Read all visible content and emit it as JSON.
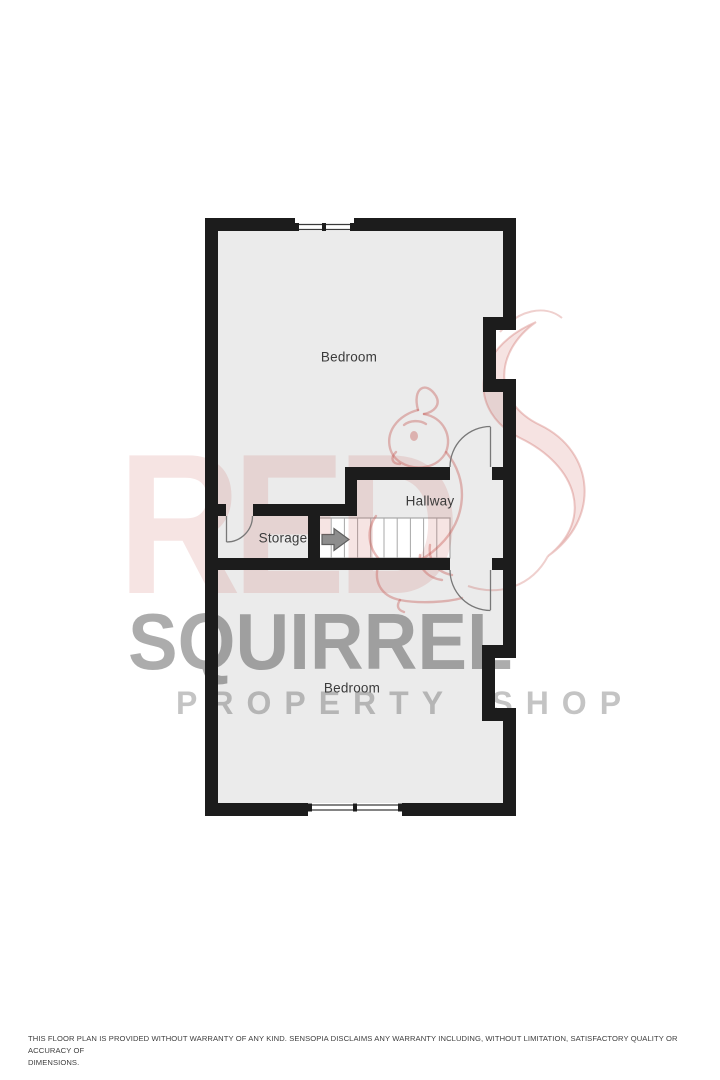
{
  "floorplan": {
    "rooms": [
      {
        "id": "bedroom-top",
        "label": "Bedroom"
      },
      {
        "id": "hallway",
        "label": "Hallway"
      },
      {
        "id": "storage",
        "label": "Storage"
      },
      {
        "id": "bedroom-bottom",
        "label": "Bedroom"
      }
    ],
    "stairs": {
      "treads": 10,
      "arrow_icon": "right-arrow",
      "direction": "up"
    },
    "features": [
      "top-window",
      "bottom-window",
      "storage-door",
      "hallway-top-door",
      "hallway-bottom-door"
    ],
    "colors": {
      "wall": "#1c1c1c",
      "floor": "#ebebeb",
      "stairs_fill": "#ffffff",
      "stair_tread_line": "#a8a8a8",
      "door_line": "#787878",
      "arrow": "#8d8d8d",
      "label_text": "#3b3b3b"
    }
  },
  "watermark": {
    "word_red": "RED",
    "word_squirrel": "SQUIRREL",
    "word_property": "PROPERTY SHOP",
    "accent_color": "#c8554f"
  },
  "footer": {
    "lines": [
      "THIS FLOOR PLAN IS PROVIDED WITHOUT WARRANTY OF ANY KIND. SENSOPIA DISCLAIMS ANY WARRANTY INCLUDING, WITHOUT LIMITATION, SATISFACTORY QUALITY OR ACCURACY OF",
      "DIMENSIONS."
    ]
  }
}
